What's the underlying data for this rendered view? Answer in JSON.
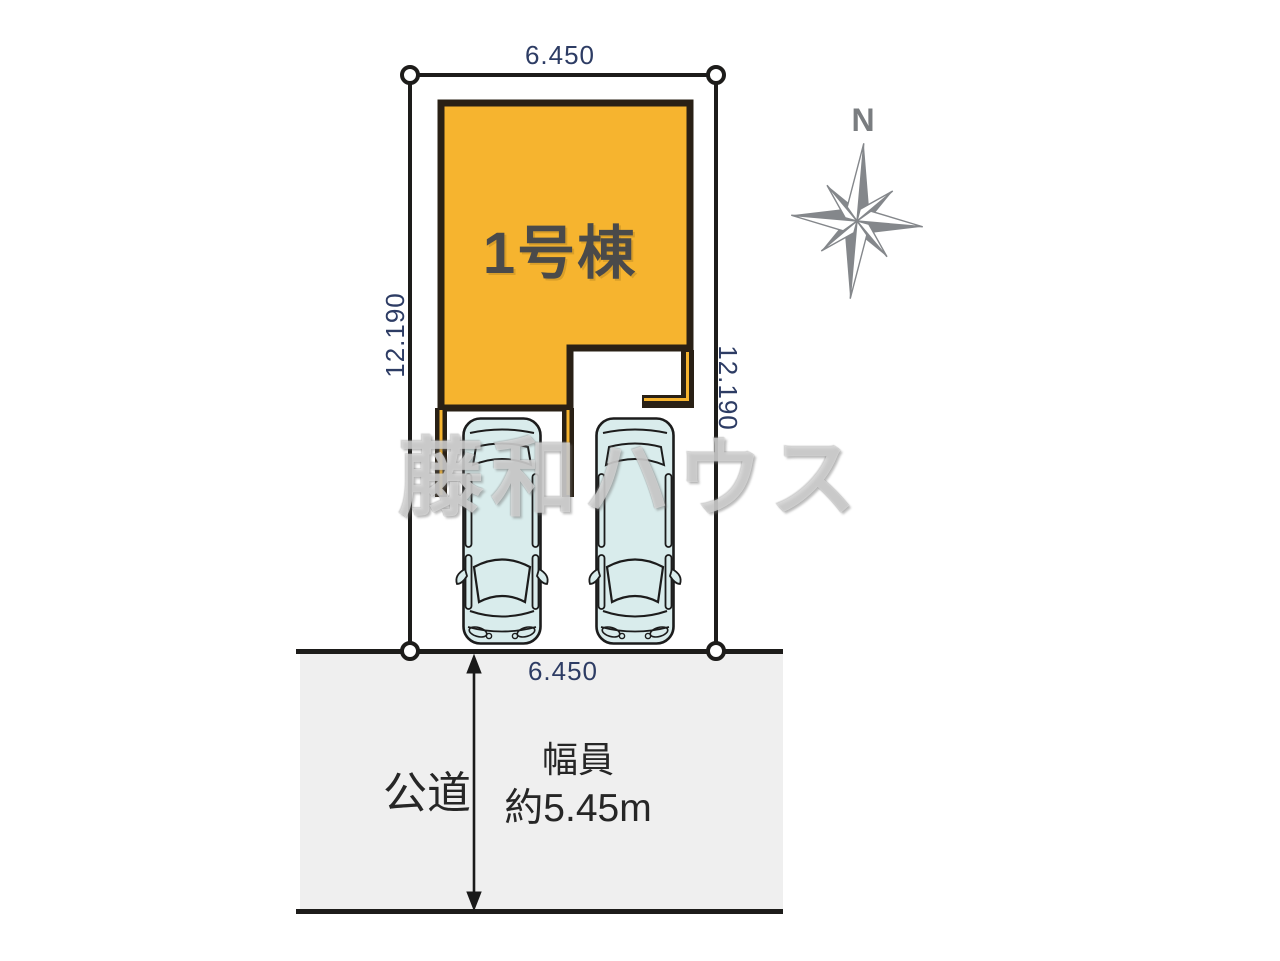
{
  "plan": {
    "building": {
      "label": "1号棟"
    },
    "dimensions": {
      "top": "6.450",
      "bottom": "6.450",
      "left": "12.190",
      "right": "12.190"
    },
    "road": {
      "name_label": "公道",
      "width_label_line1": "幅員",
      "width_label_line2": "約5.45m"
    },
    "compass": {
      "north_label": "N"
    },
    "watermark": "藤和ハウス",
    "icons": {
      "compass_rose": "compass-rose-icon",
      "road_width_arrow": "road-width-double-arrow",
      "corner_markers": "boundary-point-circle"
    }
  },
  "colors": {
    "building_fill": "#f6b42f",
    "building_outline": "#292015",
    "boundary_line": "#1d1c1a",
    "dimension_text": "#2d3c64",
    "car_fill": "#d9ecec",
    "car_outline": "#1c1c1c",
    "road_fill": "#efefef",
    "road_text": "#262626",
    "compass_gray": "#84878b",
    "watermark_color": "#fafafa"
  }
}
